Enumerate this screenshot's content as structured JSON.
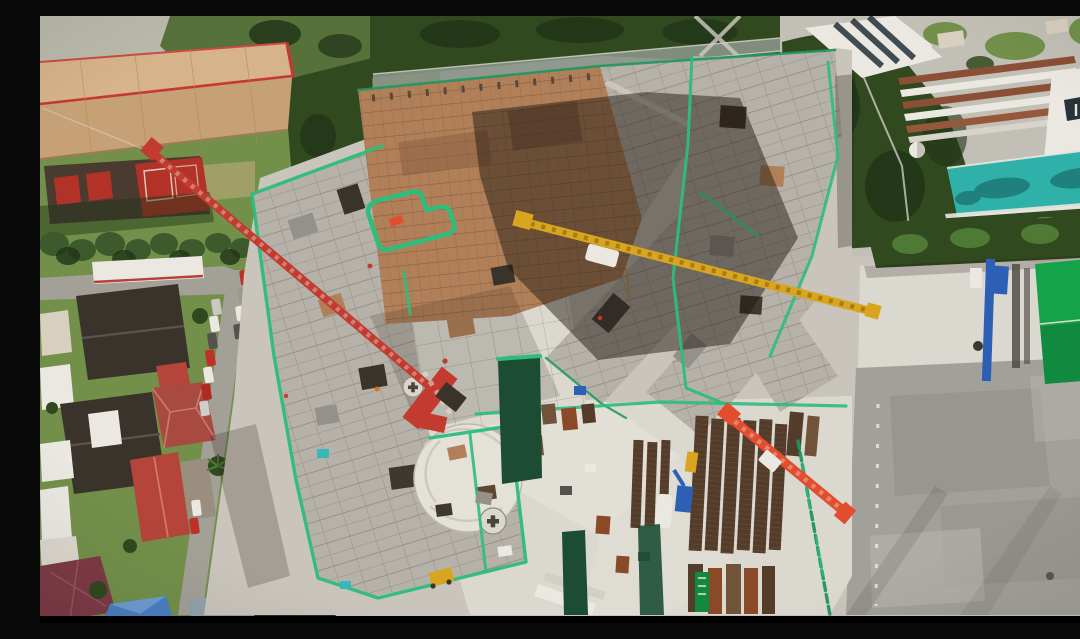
{
  "scene": {
    "title": "Aerial drone photo of a high-rise construction site",
    "description": "Top-down daytime aerial photograph of a large building construction site with concrete floor slabs outlined in bright green safety netting, terracotta formwork, a red tower crane, a yellow crane jib and an orange crane jib, a material laydown yard, a grey paved staging lot to the east, a residential neighborhood with red, dark and blue roofs to the west, a tan warehouse and sports courts to the northwest, and a modern condominium complex with a teal swimming pool and rooftop gardens to the northeast.",
    "time_of_day": "midday, hard sun with shadows cast toward lower-left",
    "view": "nadir (straight down) drone view"
  },
  "palette": {
    "grass": "#72904a",
    "grassDark": "#56713a",
    "grassDry": "#a8a26c",
    "treeDark": "#31491f",
    "treeDarker": "#1f3317",
    "conifer": "#3c5a2c",
    "roofTan": "#c7a176",
    "roofTanLight": "#d6b389",
    "roofRed": "#c23a33",
    "courtBrown": "#4a3b31",
    "courtRed": "#b23227",
    "houseDarkRoof": "#39332b",
    "houseRedRoof": "#a84a42",
    "houseRedBright": "#b5443a",
    "houseMaroon": "#7d3b46",
    "houseBlue": "#4b80c2",
    "white": "#eae8e1",
    "road": "#a3a098",
    "roadLight": "#c2bfb6",
    "ground": "#c9c5bd",
    "groundLight": "#dbd8d0",
    "slab": "#b6b2a9",
    "slabDark": "#94908a",
    "slabLine": "#8b8780",
    "formTan": "#b18059",
    "formLine": "#7c583f",
    "netGreen": "#2dbd7c",
    "netGreenDark": "#1f9560",
    "screenGreen": "#1d4c34",
    "poolTeal": "#2fb1a9",
    "poolTealDark": "#1f807e",
    "shedGreen": "#14a349",
    "shedGreenDark": "#0f8a3e",
    "craneRed": "#c23b2e",
    "craneOrange": "#e24e2d",
    "craneYellow": "#d9a51e",
    "blue": "#2d5fb5",
    "lotGrey": "#a2a09a",
    "lotGreyLight": "#b6b4ad",
    "lotGreyDark": "#8d8b85",
    "stackBrown": "#533c2a",
    "stackBrownLight": "#705339",
    "rust": "#8a4a28",
    "shadow": "#1f1810",
    "black": "#000000"
  },
  "inventory": {
    "cranes": [
      {
        "name": "northwest-tower-crane",
        "color_key": "craneRed",
        "jib_from": [
          113,
          137
        ],
        "jib_to": [
          397,
          377
        ]
      },
      {
        "name": "center-yellow-crane",
        "color_key": "craneYellow",
        "jib_from": [
          480,
          205
        ],
        "jib_to": [
          834,
          296
        ]
      },
      {
        "name": "southeast-crane",
        "color_key": "craneOrange",
        "jib_from": [
          687,
          399
        ],
        "jib_to": [
          806,
          497
        ]
      }
    ],
    "buildings_under_construction": [
      "west-wing",
      "southwest-wing",
      "north-terracotta-block",
      "northeast-wing",
      "east-diagonal-wings"
    ],
    "neighborhood_roofs": [
      "dark-gable",
      "red-hip",
      "bright-red",
      "maroon",
      "blue-pyramid",
      "white-canopies"
    ],
    "amenities": [
      "condo-swimming-pool",
      "rooftop-gardens",
      "white-dome-gazebo",
      "sports-courts",
      "warehouse"
    ],
    "site_features": [
      "green-safety-netting",
      "material-stacks",
      "laydown-yard",
      "dark-green-screens",
      "paved-staging-lot",
      "green-roofed-shed",
      "circular-slab"
    ]
  },
  "letterbox": {
    "bottom_bar_height_px": 7
  }
}
